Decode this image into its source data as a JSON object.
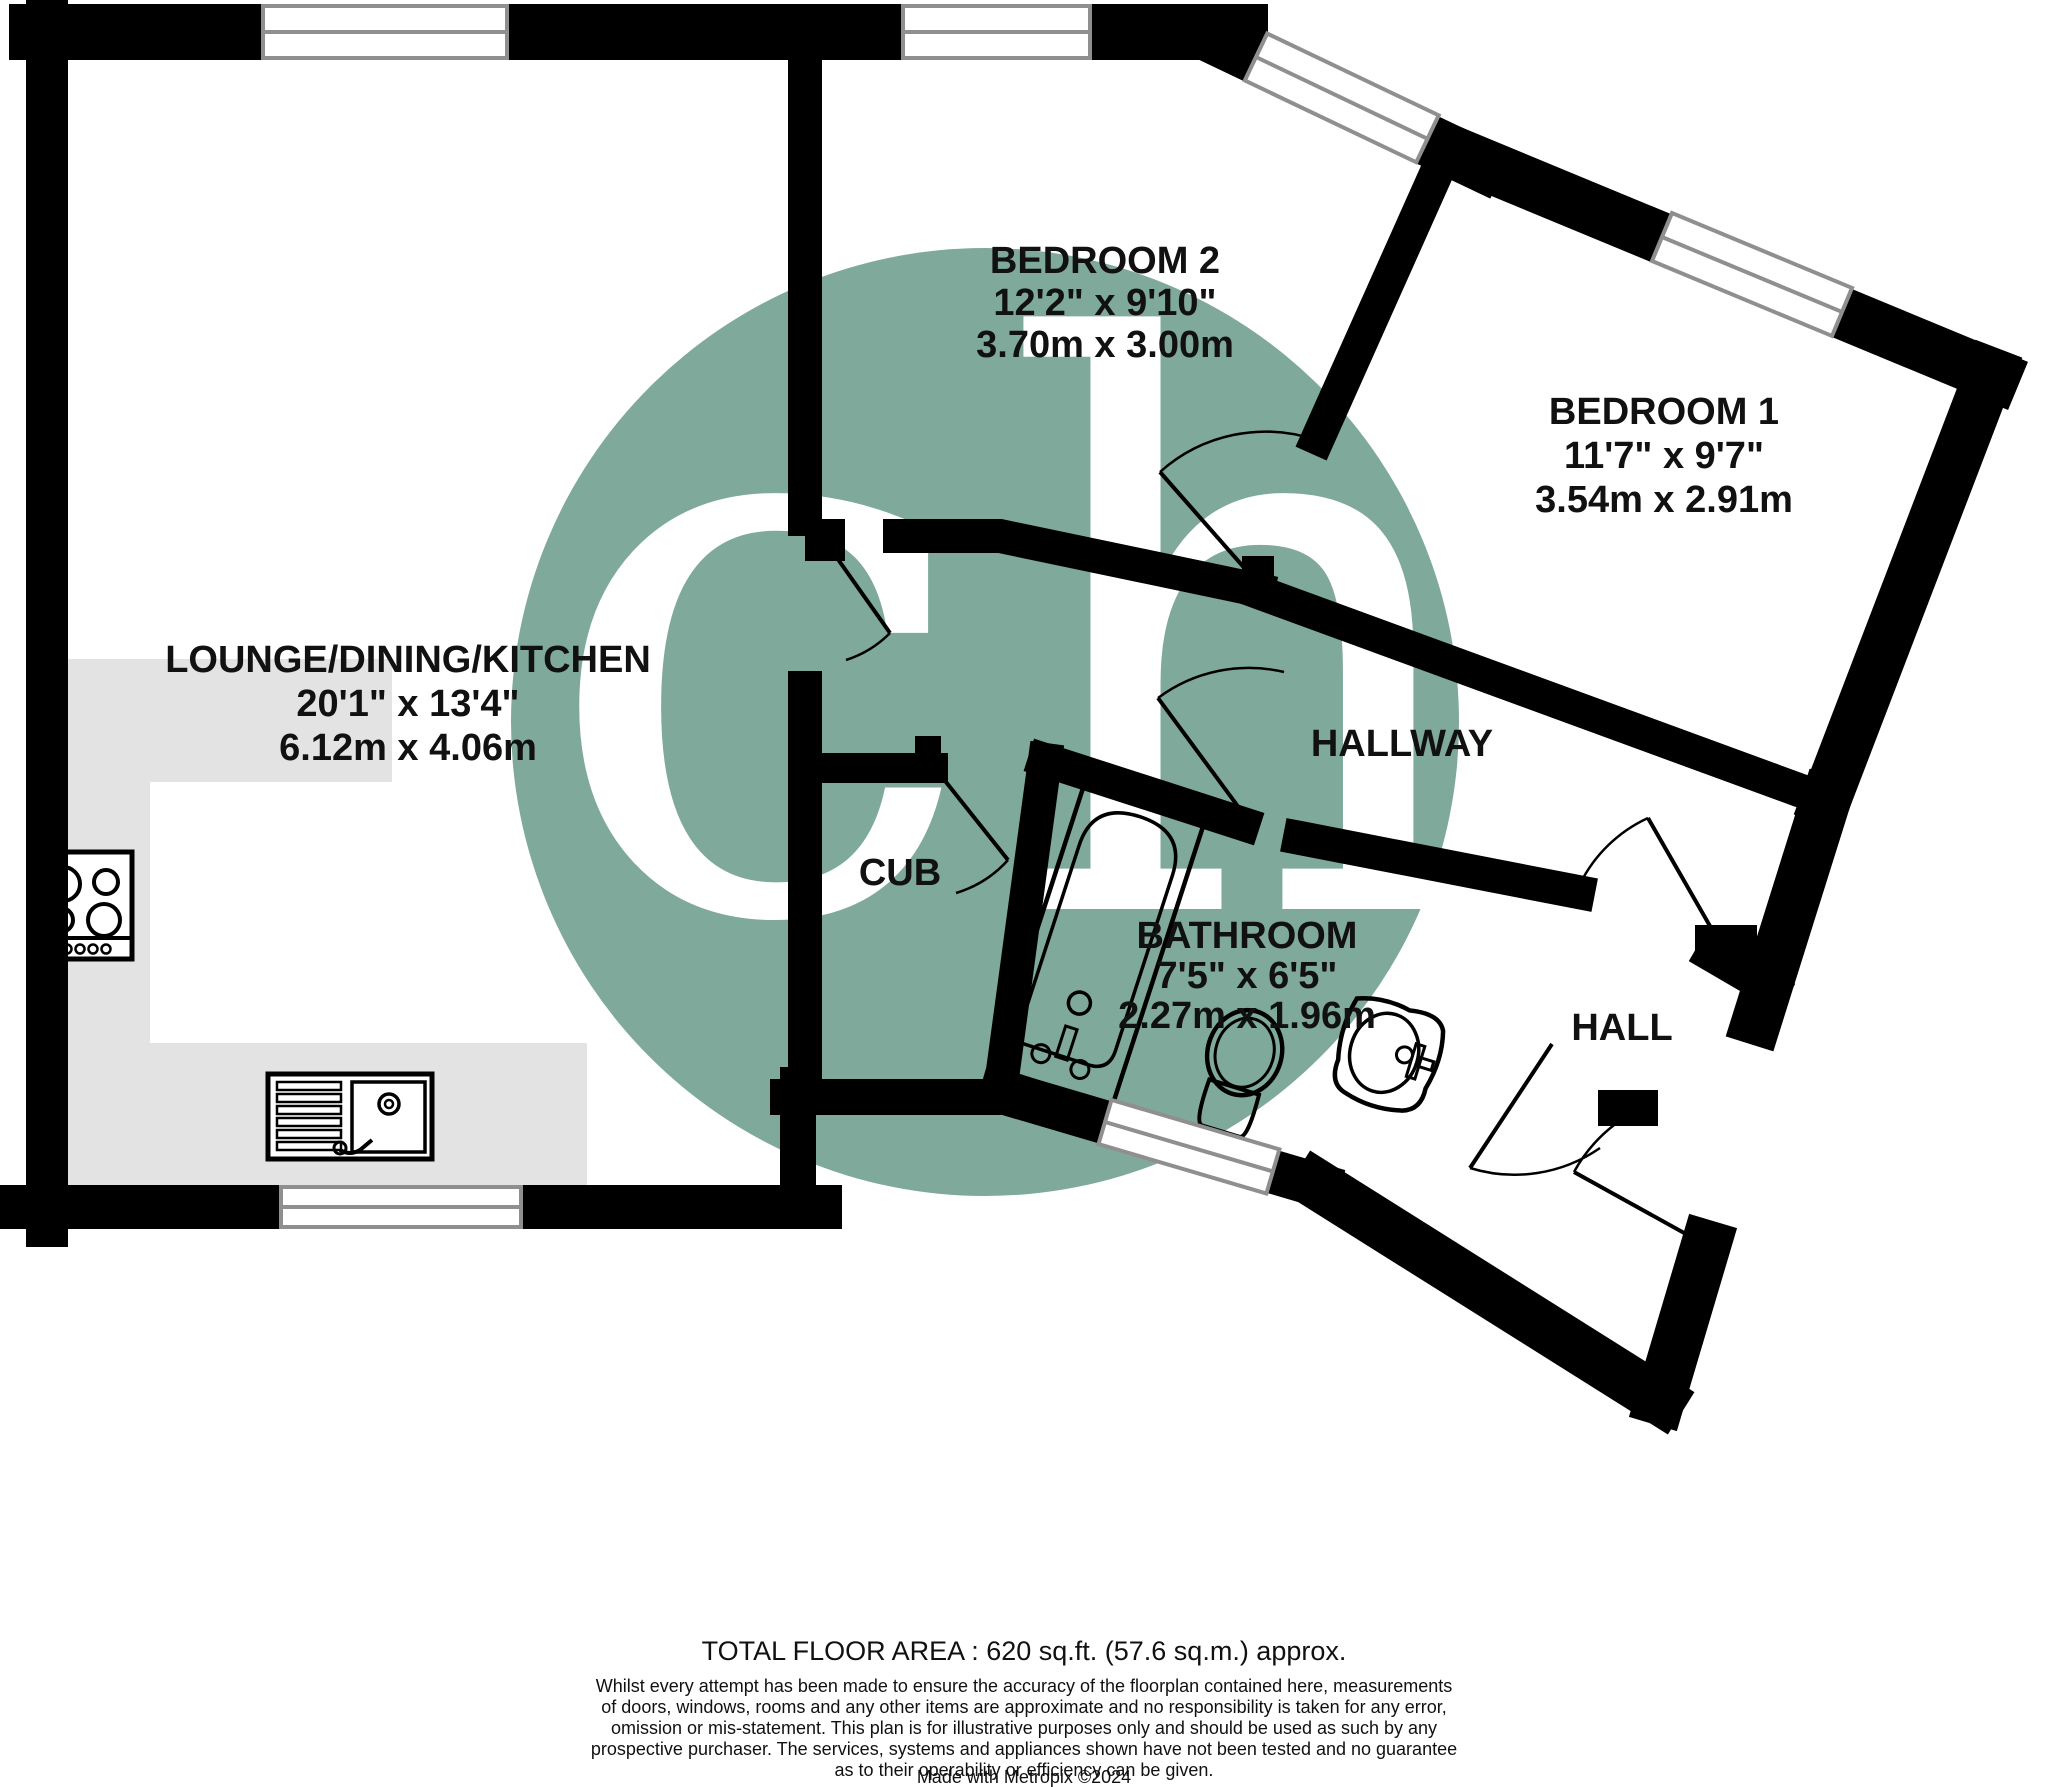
{
  "plan": {
    "rooms": [
      {
        "name": "LOUNGE/DINING/KITCHEN",
        "dims_imperial": "20'1\"  x 13'4\"",
        "dims_metric": "6.12m  x 4.06m"
      },
      {
        "name": "BEDROOM 2",
        "dims_imperial": "12'2\"  x 9'10\"",
        "dims_metric": "3.70m  x 3.00m"
      },
      {
        "name": "BEDROOM 1",
        "dims_imperial": "11'7\"  x 9'7\"",
        "dims_metric": "3.54m  x 2.91m"
      },
      {
        "name": "BATHROOM",
        "dims_imperial": "7'5\"  x 6'5\"",
        "dims_metric": "2.27m  x 1.96m"
      },
      {
        "name": "HALLWAY"
      },
      {
        "name": "HALL"
      },
      {
        "name": "CUB"
      }
    ],
    "watermark": {
      "text": "ch",
      "color": "#7FA99B"
    },
    "colors": {
      "wall": "#000000",
      "kitchen_counter": "#e3e3e3",
      "window_frame": "#8f8f8f"
    }
  },
  "footer": {
    "total_area": "TOTAL FLOOR AREA : 620 sq.ft. (57.6 sq.m.) approx.",
    "disclaimer_lines": [
      "Whilst every attempt has been made to ensure the accuracy of the floorplan contained here, measurements",
      "of doors, windows, rooms and any other items are approximate and no responsibility is taken for any error,",
      "omission or mis-statement. This plan is for illustrative purposes only and should be used as such by any",
      "prospective purchaser. The services, systems and appliances shown have not been tested and no guarantee",
      "as to their operability or efficiency can be given."
    ],
    "credit": "Made with Metropix ©2024"
  }
}
